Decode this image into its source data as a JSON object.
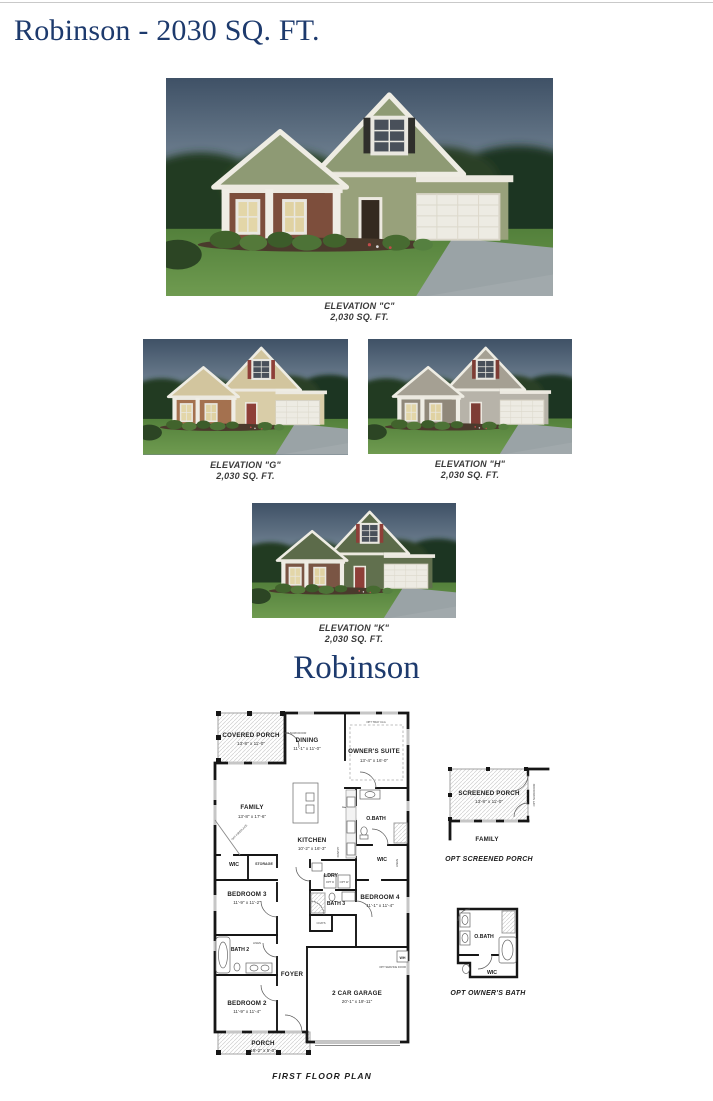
{
  "page": {
    "title": "Robinson - 2030 SQ. FT.",
    "plan_heading": "Robinson",
    "floor_plan_caption": "FIRST FLOOR PLAN"
  },
  "elevations": {
    "c": {
      "name": "ELEVATION \"C\"",
      "sqft": "2,030 SQ. FT.",
      "colors": {
        "siding": "#98a17b",
        "gable": "#8e9a74",
        "accent": "#7d4e3c",
        "door": "#342a20",
        "shutter": "#2f2f2b"
      }
    },
    "g": {
      "name": "ELEVATION \"G\"",
      "sqft": "2,030 SQ. FT.",
      "colors": {
        "siding": "#d9cda8",
        "gable": "#d2c59e",
        "accent": "#a4714f",
        "door": "#8e3f38",
        "shutter": "#8e3f38"
      }
    },
    "h": {
      "name": "ELEVATION \"H\"",
      "sqft": "2,030 SQ. FT.",
      "colors": {
        "siding": "#b7b3a9",
        "gable": "#a5a093",
        "accent": "#90887a",
        "door": "#7e3d35",
        "shutter": "#7e3d35"
      }
    },
    "k": {
      "name": "ELEVATION \"K\"",
      "sqft": "2,030 SQ. FT.",
      "colors": {
        "siding": "#61704e",
        "gable": "#5c6b4a",
        "accent": "#7a5544",
        "door": "#8e3f38",
        "shutter": "#8e3f38"
      }
    }
  },
  "floor_plan": {
    "rooms": {
      "covered_porch": {
        "label": "COVERED PORCH",
        "dims": "13'-8\" x 11'-0\""
      },
      "dining": {
        "label": "DINING",
        "dims": "11'-1\" x 11'-0\""
      },
      "owners_suite": {
        "label": "OWNER'S SUITE",
        "dims": "13'-4\" x 16'-0\""
      },
      "family": {
        "label": "FAMILY",
        "dims": "13'-8\" x 17'-6\""
      },
      "kitchen": {
        "label": "KITCHEN",
        "dims": "10'-2\" x 16'-3\""
      },
      "obath": {
        "label": "O.BATH"
      },
      "wic_right": {
        "label": "WIC"
      },
      "wic_left": {
        "label": "WIC"
      },
      "storage": {
        "label": "STORAGE"
      },
      "bedroom3": {
        "label": "BEDROOM 3",
        "dims": "11'-9\" x 11'-2\""
      },
      "ldry": {
        "label": "LDRY"
      },
      "bath3": {
        "label": "BATH 3"
      },
      "bedroom4": {
        "label": "BEDROOM 4",
        "dims": "11'-1\" x 11'-4\""
      },
      "bath2": {
        "label": "BATH 2"
      },
      "foyer": {
        "label": "FOYER"
      },
      "bedroom2": {
        "label": "BEDROOM 2",
        "dims": "11'-9\" x 11'-4\""
      },
      "garage": {
        "label": "2 CAR GARAGE",
        "dims": "20'-1\" x 19'-11\""
      },
      "porch": {
        "label": "PORCH",
        "dims": "19'-2\" x 5'-0\""
      }
    },
    "annotations": {
      "opt_fireplace": "OPT FIREPLACE",
      "pantry": "PANTRY",
      "coats": "COATS",
      "linen": "LINEN",
      "opt_tray": "OPT TRAY CLG",
      "opt_scrn_door": "OPT SCRN DOOR",
      "opt_d": "OPT D",
      "opt_w": "OPT W",
      "wh": "WH",
      "opt_service_door": "OPT SERVICE DOOR"
    },
    "details": {
      "screened_porch": {
        "caption": "OPT SCREENED PORCH",
        "room": {
          "label": "SCREENED PORCH",
          "dims": "13'-8\" x 11'-0\""
        },
        "family_label": "FAMILY",
        "door_note": "OPT SCRN DOOR"
      },
      "owners_bath": {
        "caption": "OPT OWNER'S BATH",
        "obath_label": "O.BATH",
        "wic_label": "WIC"
      }
    }
  },
  "colors": {
    "heading_navy": "#1d3a6d",
    "caption_gray": "#3a3a3a",
    "plan_ink": "#161616"
  }
}
